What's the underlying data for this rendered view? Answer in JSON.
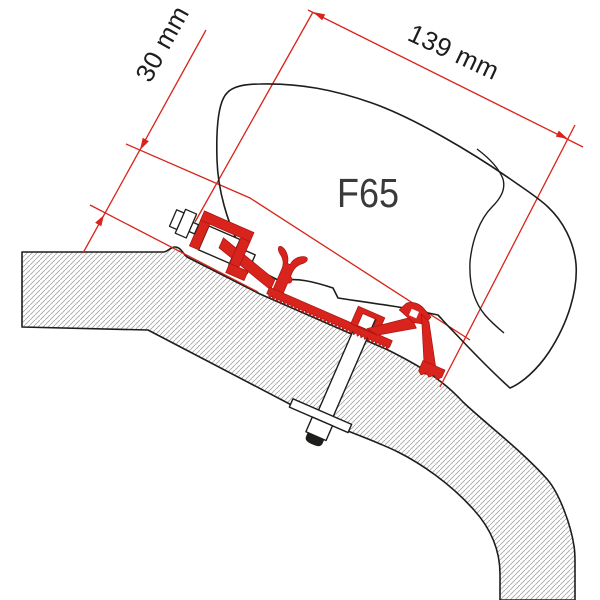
{
  "diagram": {
    "product_label": "F65",
    "dimensions": {
      "rail_height": "30 mm",
      "bracket_span": "139 mm"
    },
    "colors": {
      "accent_red": "#d8241c",
      "outline_black": "#1d1d1b",
      "hatch_gray": "#a8a8a8",
      "background": "#ffffff"
    }
  }
}
